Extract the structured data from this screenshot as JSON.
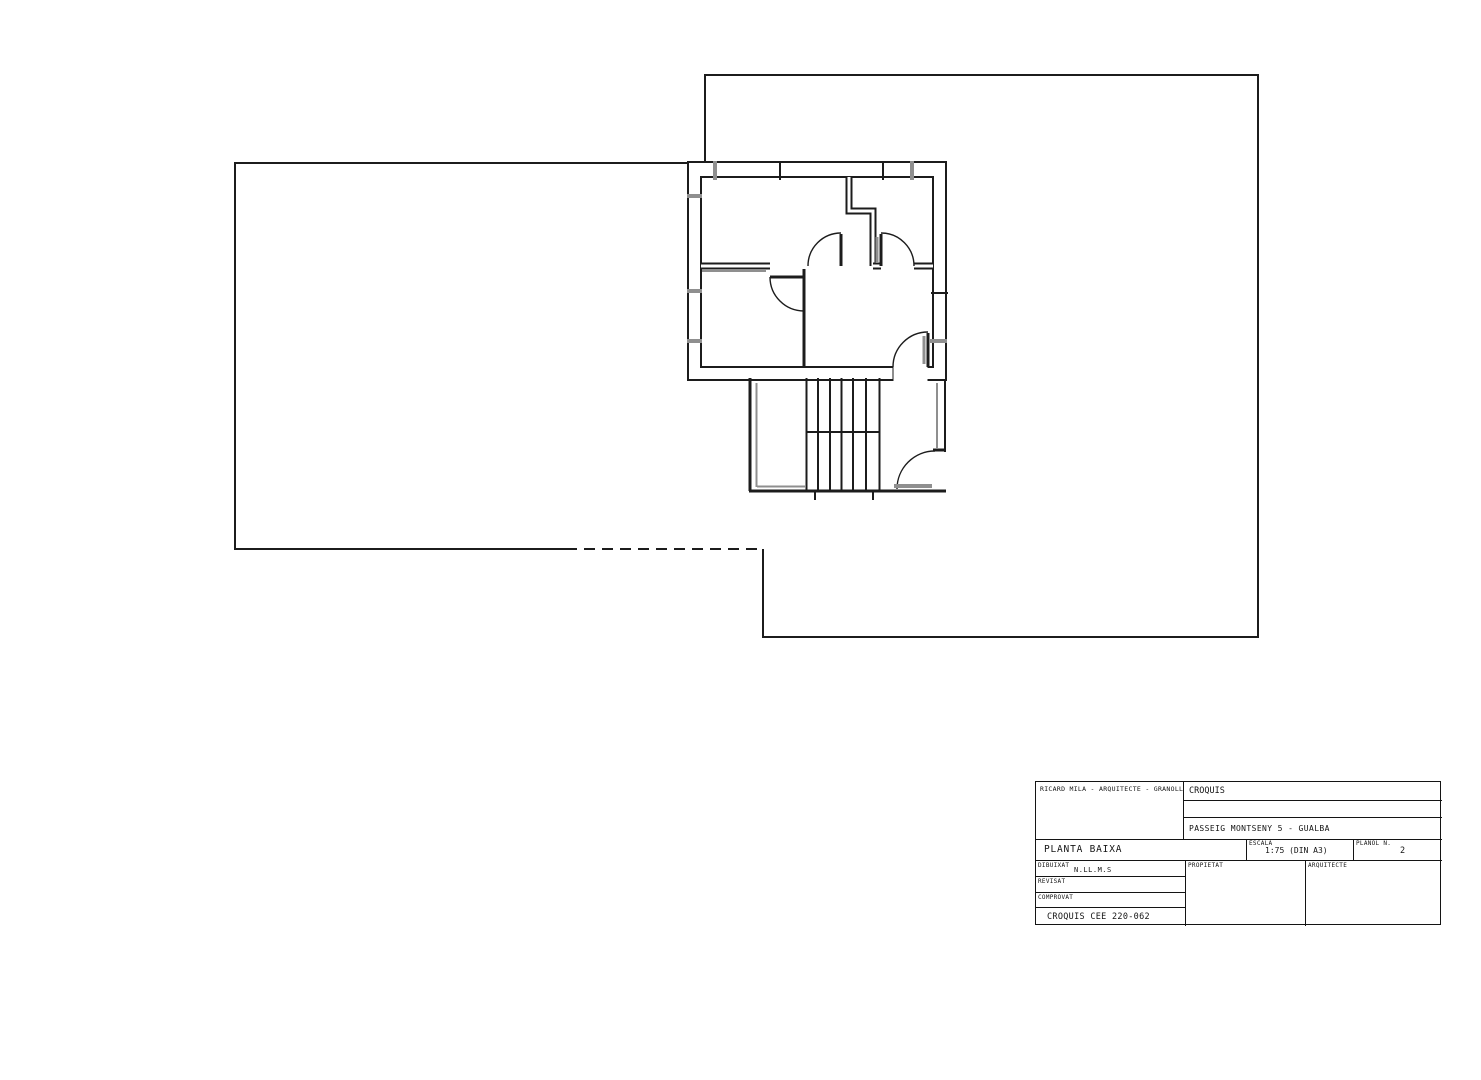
{
  "drawing": {
    "plan_name": "PLANTA BAIXA",
    "title_block": {
      "firm": "RICARD MILA - ARQUITECTE - GRANOLLERS",
      "doc_type": "CROQUIS",
      "address": "PASSEIG MONTSENY 5 - GUALBA",
      "plan_name": "PLANTA BAIXA",
      "scale": {
        "label": "ESCALA",
        "value": "1:75 (DIN A3)"
      },
      "sheet": {
        "label": "PLANOL N.",
        "value": "2"
      },
      "rows": [
        {
          "label": "DIBUIXAT",
          "value": "N.LL.M.S"
        },
        {
          "label": "REVISAT",
          "value": ""
        },
        {
          "label": "COMPROVAT",
          "value": ""
        }
      ],
      "doc_ref": "CROQUIS CEE 220-062",
      "owner_label": "PROPIETAT",
      "architect_label": "ARQUITECTE"
    },
    "colors": {
      "line": "#1c1c1c",
      "glazing_gray": "#8f8f8f",
      "paper": "#ffffff"
    }
  }
}
